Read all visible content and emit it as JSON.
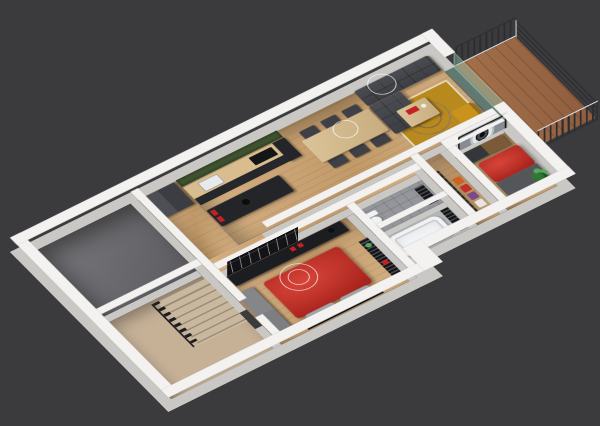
{
  "scene": {
    "type": "3d-floor-plan-render",
    "projection": "axonometric-high-angle",
    "background": "#3b3b3d"
  },
  "palette": {
    "bg": "#3b3b3d",
    "wall_top": "#f3f2f0",
    "wall_side": "#c9c8c5",
    "wood_a": "#d6b286",
    "wood_b": "#c29a69",
    "utility_floor_a": "#7a7a7e",
    "utility_floor_b": "#5c5c60",
    "stair_floor": "#c6b197",
    "tread_a": "#c9b8a0",
    "tread_b": "#9b8970",
    "railing_dark": "#1d1d1f",
    "tile_wc": "#95969b",
    "tile_bath": "#b4b5b9",
    "tub_white": "#f1f2f4",
    "sofa_a": "#4b4d52",
    "sofa_b": "#3c3e43",
    "rug": "#b8891c",
    "rug_line": "#e8ddc2",
    "armchair": "#c8921c",
    "table_wood": "#dcc49a",
    "chair_dark": "#3f4045",
    "moss": "#3f5430",
    "counter_wood": "#dabd8e",
    "counter_dark": "#26272b",
    "cooktop": "#141517",
    "sink": "#e8e9ea",
    "island_dark": "#232529",
    "accent_red": "#c42222",
    "bed_red_a": "#d8453a",
    "bed_red_b": "#a8241d",
    "bed_gray": "#55565a",
    "pillow": "#a2a4a8",
    "frame_dark": "#141416",
    "wardrobe_gray": "#85868a",
    "sideboard": "#1c1d21",
    "closet_dark": "#2b2620",
    "clothes_orange": "#d06020",
    "clothes_red": "#c03028",
    "clothes_purple": "#7a4a8a",
    "clothes_white": "#e8e6e2",
    "dresser_dark": "#33363a",
    "dresser_wood": "#7a5a38",
    "plant_a": "#2e7a35",
    "plant_b": "#55a85c",
    "pot": "#2a2a2c",
    "balcony_floor": "#a4714b",
    "balcony_line": "#8f5d3e",
    "rail_bar": "#2c2d31",
    "rail_top": "#d5d5d7",
    "glass": "rgba(145,195,175,0.45)",
    "letterboard": "#141418",
    "eye_frame": "#101012",
    "wire": "rgba(255,255,255,0.8)"
  },
  "rooms": [
    {
      "name": "utility room",
      "floor": "gray concrete"
    },
    {
      "name": "stair hall",
      "floor": "beige tile",
      "furniture": [
        "staircase",
        "stair railing"
      ]
    },
    {
      "name": "entry hall",
      "floor": "oak",
      "furniture": [
        "gray wardrobe boxes"
      ]
    },
    {
      "name": "kitchen",
      "floor": "oak",
      "furniture": [
        "moss green wall",
        "wood counter",
        "cooktop",
        "sink",
        "tall cabinet",
        "dark island",
        "red canisters",
        "black bowl"
      ]
    },
    {
      "name": "dining area",
      "floor": "oak",
      "furniture": [
        "wood dining table",
        "six dark chairs"
      ]
    },
    {
      "name": "living room",
      "floor": "oak",
      "furniture": [
        "gray tufted sectional sofa",
        "mustard area rug",
        "wood coffee table",
        "red tray",
        "mustard armchair",
        "wireframe ceiling light"
      ]
    },
    {
      "name": "corridor",
      "floor": "oak"
    },
    {
      "name": "master bedroom",
      "floor": "oak",
      "furniture": [
        "red double bed",
        "gray pillows",
        "gray wardrobe",
        "dark sideboard",
        "script letterboard",
        "black ladder shelf",
        "wireframe chandelier"
      ]
    },
    {
      "name": "wc",
      "floor": "gray tile",
      "furniture": [
        "toilet",
        "black ladder shelf"
      ]
    },
    {
      "name": "bathroom",
      "floor": "marble tile",
      "furniture": [
        "bathtub",
        "black towel radiator"
      ]
    },
    {
      "name": "dressing closet",
      "floor": "oak",
      "furniture": [
        "dark shelving",
        "hanging clothes orange red purple white"
      ]
    },
    {
      "name": "bedroom 2",
      "floor": "oak",
      "furniture": [
        "red and gray double bed",
        "two-tone dresser",
        "eye art tv panel",
        "potted plant"
      ]
    },
    {
      "name": "balcony",
      "floor": "terracotta planks",
      "furniture": [
        "dark bar railing",
        "glass door wall"
      ]
    }
  ],
  "light_fixtures": [
    "wire-circle over sofa",
    "wire-circle over dining",
    "double wire-circle over master bed"
  ]
}
